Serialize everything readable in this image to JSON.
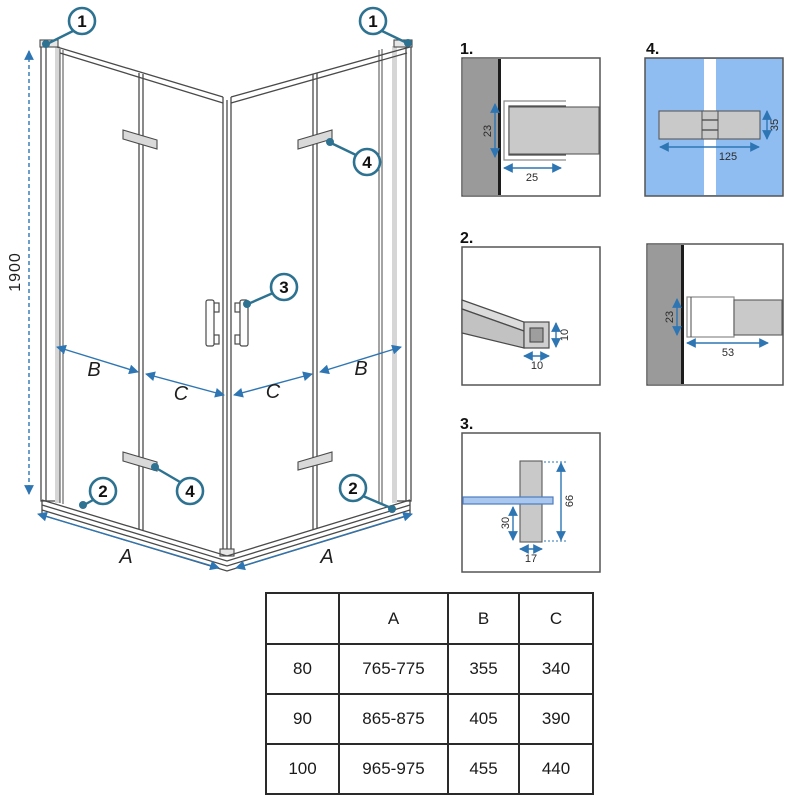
{
  "drawing": {
    "dim_height": "1900",
    "dim_a": "A",
    "dim_b": "B",
    "dim_c": "C",
    "callout_1": "1",
    "callout_2": "2",
    "callout_3": "3",
    "callout_4": "4"
  },
  "details": {
    "d1": {
      "label": "1.",
      "dim_depth": "23",
      "dim_width": "25"
    },
    "d2": {
      "label": "2.",
      "dim_height": "10",
      "dim_width": "10"
    },
    "d3": {
      "label": "3.",
      "dim_lower": "30",
      "dim_total": "66",
      "dim_width": "17"
    },
    "d4": {
      "label": "4.",
      "dim_width": "125",
      "dim_height": "35"
    },
    "d5": {
      "dim_depth": "23",
      "dim_width": "53"
    }
  },
  "size_table": {
    "headers": [
      "",
      "A",
      "B",
      "C"
    ],
    "rows": [
      [
        "80",
        "765-775",
        "355",
        "340"
      ],
      [
        "90",
        "865-875",
        "405",
        "390"
      ],
      [
        "100",
        "965-975",
        "455",
        "440"
      ]
    ]
  },
  "colors": {
    "dimension_blue": "#2e76b3",
    "callout_teal": "#2d7291",
    "glass_blue": "#8fbdf2",
    "wall_gray": "#9a9a9a",
    "part_gray": "#c9c9c9"
  }
}
